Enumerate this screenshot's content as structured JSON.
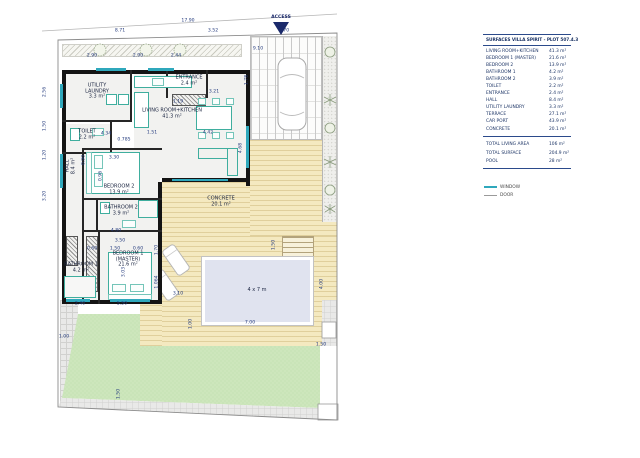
{
  "access": {
    "label": "ACCESS",
    "color": "#1b2a6b"
  },
  "legend": {
    "window": "WINDOW",
    "door": "DOOR"
  },
  "surfaces_table": {
    "title": "SURFACES VILLA SPIRIT - PLOT 507.4.3",
    "rows": [
      {
        "label": "LIVING ROOM+KITCHEN",
        "value": "41.3 m²"
      },
      {
        "label": "BEDROOM 1 (MASTER)",
        "value": "21.6 m²"
      },
      {
        "label": "BEDROOM 2",
        "value": "13.9 m²"
      },
      {
        "label": "BATHROOM 1",
        "value": "4.2 m²"
      },
      {
        "label": "BATHROOM 2",
        "value": "3.9 m²"
      },
      {
        "label": "TOILET",
        "value": "2.2 m²"
      },
      {
        "label": "ENTRANCE",
        "value": "2.4 m²"
      },
      {
        "label": "HALL",
        "value": "8.4 m²"
      },
      {
        "label": "UTILITY LAUNDRY",
        "value": "3.3 m²"
      },
      {
        "label": "TERRACE",
        "value": "27.1 m²"
      },
      {
        "label": "CAR PORT",
        "value": "43.9 m²"
      },
      {
        "label": "CONCRETE",
        "value": "20.1 m²"
      }
    ],
    "totals": [
      {
        "label": "TOTAL LIVING AREA",
        "value": "106 m²"
      },
      {
        "label": "TOTAL SURFACE",
        "value": "204.9 m²"
      },
      {
        "label": "POOL",
        "value": "28 m²"
      }
    ],
    "accent_color": "#2b4a8b"
  },
  "plan": {
    "colors": {
      "wall": "#141414",
      "window": "#2fa8bc",
      "furniture": "#3fae9e",
      "terrace": "#f4e9c0",
      "lawn": "#cde6bc",
      "pool": "#e0e3ef",
      "dim_text": "#233a7d"
    },
    "floors": [
      [
        66,
        74,
        64,
        46
      ],
      [
        66,
        124,
        44,
        28
      ],
      [
        66,
        150,
        16,
        150
      ],
      [
        84,
        150,
        76,
        48
      ],
      [
        84,
        200,
        76,
        30
      ],
      [
        66,
        232,
        32,
        68
      ],
      [
        100,
        232,
        58,
        68
      ],
      [
        134,
        74,
        112,
        104
      ],
      [
        168,
        74,
        40,
        32
      ]
    ],
    "walls": [
      [
        62,
        70,
        188,
        4
      ],
      [
        62,
        70,
        4,
        234
      ],
      [
        62,
        300,
        100,
        4
      ],
      [
        158,
        182,
        4,
        122
      ],
      [
        246,
        70,
        4,
        116
      ],
      [
        162,
        178,
        88,
        4
      ]
    ],
    "iwalls": [
      [
        62,
        120,
        70,
        2
      ],
      [
        130,
        70,
        2,
        52
      ],
      [
        62,
        152,
        50,
        2
      ],
      [
        110,
        122,
        2,
        32
      ],
      [
        82,
        148,
        2,
        156
      ],
      [
        82,
        148,
        80,
        2
      ],
      [
        82,
        198,
        80,
        2
      ],
      [
        96,
        200,
        2,
        30
      ],
      [
        82,
        230,
        80,
        2
      ],
      [
        98,
        230,
        2,
        74
      ],
      [
        166,
        70,
        2,
        28
      ],
      [
        206,
        70,
        2,
        28
      ]
    ],
    "windows": [
      [
        96,
        68,
        30,
        3
      ],
      [
        148,
        68,
        26,
        3
      ],
      [
        60,
        84,
        3,
        24
      ],
      [
        60,
        154,
        3,
        34
      ],
      [
        66,
        299,
        24,
        3
      ],
      [
        110,
        299,
        40,
        3
      ],
      [
        246,
        126,
        3,
        42
      ],
      [
        172,
        179,
        56,
        2
      ]
    ],
    "hatches": [
      [
        66,
        236,
        12,
        30
      ],
      [
        86,
        236,
        12,
        56
      ],
      [
        172,
        94,
        34,
        12
      ]
    ],
    "furniture": [
      [
        106,
        94,
        11,
        11,
        "unit"
      ],
      [
        118,
        94,
        11,
        11,
        "unit"
      ],
      [
        70,
        128,
        10,
        13,
        "unit"
      ],
      [
        92,
        128,
        12,
        8,
        "inner"
      ],
      [
        134,
        76,
        58,
        12,
        "unit"
      ],
      [
        152,
        78,
        12,
        8,
        "inner"
      ],
      [
        134,
        92,
        15,
        36,
        "unit"
      ],
      [
        196,
        106,
        36,
        24,
        "unit"
      ],
      [
        198,
        98,
        8,
        7,
        "inner"
      ],
      [
        212,
        98,
        8,
        7,
        "inner"
      ],
      [
        226,
        98,
        8,
        7,
        "inner"
      ],
      [
        198,
        132,
        8,
        7,
        "inner"
      ],
      [
        212,
        132,
        8,
        7,
        "inner"
      ],
      [
        226,
        132,
        8,
        7,
        "inner"
      ],
      [
        198,
        148,
        40,
        11,
        "sofa"
      ],
      [
        227,
        148,
        11,
        28,
        "sofa"
      ],
      [
        86,
        152,
        54,
        42,
        "unit"
      ],
      [
        86,
        152,
        6,
        42,
        "inner"
      ],
      [
        94,
        155,
        9,
        14,
        "inner"
      ],
      [
        94,
        173,
        9,
        14,
        "inner"
      ],
      [
        108,
        252,
        44,
        48,
        "unit"
      ],
      [
        108,
        294,
        44,
        6,
        "inner"
      ],
      [
        112,
        284,
        14,
        8,
        "inner"
      ],
      [
        130,
        284,
        14,
        8,
        "inner"
      ],
      [
        64,
        276,
        32,
        22,
        "tub"
      ],
      [
        138,
        200,
        20,
        18,
        "tub"
      ],
      [
        100,
        202,
        10,
        12,
        "unit"
      ],
      [
        122,
        220,
        14,
        8,
        "inner"
      ]
    ],
    "room_labels": [
      {
        "n": "utility-laundry",
        "l": [
          "UTILITY",
          "LAUNDRY",
          "3.3 m²"
        ],
        "x": 97,
        "y": 92,
        "v": 0
      },
      {
        "n": "toilet",
        "l": [
          "TOILET",
          "2.2 m²"
        ],
        "x": 87,
        "y": 135,
        "v": 0
      },
      {
        "n": "hall",
        "l": [
          "HALL",
          "8.4 m²"
        ],
        "x": 71,
        "y": 166,
        "v": 1
      },
      {
        "n": "entrance",
        "l": [
          "ENTRANCE",
          "2.4 m²"
        ],
        "x": 189,
        "y": 81,
        "v": 0
      },
      {
        "n": "living-room-kitchen",
        "l": [
          "LIVING ROOM+KITCHEN",
          "41.3 m²"
        ],
        "x": 172,
        "y": 114,
        "v": 0
      },
      {
        "n": "bedroom-2",
        "l": [
          "BEDROOM 2",
          "13.9 m²"
        ],
        "x": 119,
        "y": 190,
        "v": 0
      },
      {
        "n": "bathroom-2",
        "l": [
          "BATHROOM 2",
          "3.9 m²"
        ],
        "x": 121,
        "y": 211,
        "v": 0
      },
      {
        "n": "bathroom-1",
        "l": [
          "BATHROOM 1",
          "4.2 m²"
        ],
        "x": 81,
        "y": 268,
        "v": 0
      },
      {
        "n": "bedroom-1-master",
        "l": [
          "BEDROOM 1",
          "(MASTER)",
          "21.6 m²"
        ],
        "x": 128,
        "y": 260,
        "v": 0
      },
      {
        "n": "concrete",
        "l": [
          "CONCRETE",
          "20.1 m²"
        ],
        "x": 221,
        "y": 202,
        "v": 0
      },
      {
        "n": "pool-size",
        "l": [
          "4 x 7 m"
        ],
        "x": 257,
        "y": 291,
        "v": 0
      }
    ],
    "dims": [
      [
        "17.90",
        188,
        22,
        0
      ],
      [
        "8.71",
        120,
        32,
        0
      ],
      [
        "3.52",
        213,
        32,
        0
      ],
      [
        "5.70",
        284,
        32,
        0
      ],
      [
        "2.90",
        92,
        57,
        0
      ],
      [
        "2.90",
        138,
        57,
        0
      ],
      [
        "2.44",
        176,
        57,
        0
      ],
      [
        "9.10",
        258,
        50,
        0
      ],
      [
        "1.78",
        248,
        80,
        1
      ],
      [
        "4.68",
        242,
        148,
        1
      ],
      [
        "3.21",
        214,
        93,
        0
      ],
      [
        "1.19",
        178,
        103,
        0
      ],
      [
        "4.34",
        106,
        135,
        0
      ],
      [
        "0.785",
        124,
        141,
        0
      ],
      [
        "1.51",
        152,
        134,
        0
      ],
      [
        "4.42",
        208,
        134,
        0
      ],
      [
        "0.90",
        85,
        160,
        1
      ],
      [
        "3.30",
        114,
        159,
        0
      ],
      [
        "0.96",
        102,
        176,
        1
      ],
      [
        "2.56",
        46,
        92,
        1
      ],
      [
        "1.50",
        46,
        126,
        1
      ],
      [
        "1.20",
        46,
        155,
        1
      ],
      [
        "3.20",
        46,
        196,
        1
      ],
      [
        "4.80",
        116,
        232,
        0
      ],
      [
        "3.50",
        120,
        242,
        0
      ],
      [
        "0.60",
        92,
        250,
        0
      ],
      [
        "1.50",
        115,
        250,
        0
      ],
      [
        "0.60",
        138,
        250,
        0
      ],
      [
        "3.03",
        125,
        272,
        1
      ],
      [
        "1.70",
        158,
        250,
        1
      ],
      [
        "1.064",
        158,
        282,
        1
      ],
      [
        "2.40",
        80,
        305,
        0
      ],
      [
        "5.50",
        122,
        305,
        0
      ],
      [
        "1.00",
        64,
        338,
        0
      ],
      [
        "3.10",
        178,
        295,
        0
      ],
      [
        "1.00",
        192,
        324,
        1
      ],
      [
        "7.00",
        250,
        324,
        0
      ],
      [
        "1.50",
        275,
        245,
        1
      ],
      [
        "4.00",
        323,
        284,
        1
      ],
      [
        "1.50",
        321,
        346,
        0
      ],
      [
        "1.50",
        120,
        394,
        1
      ]
    ]
  }
}
